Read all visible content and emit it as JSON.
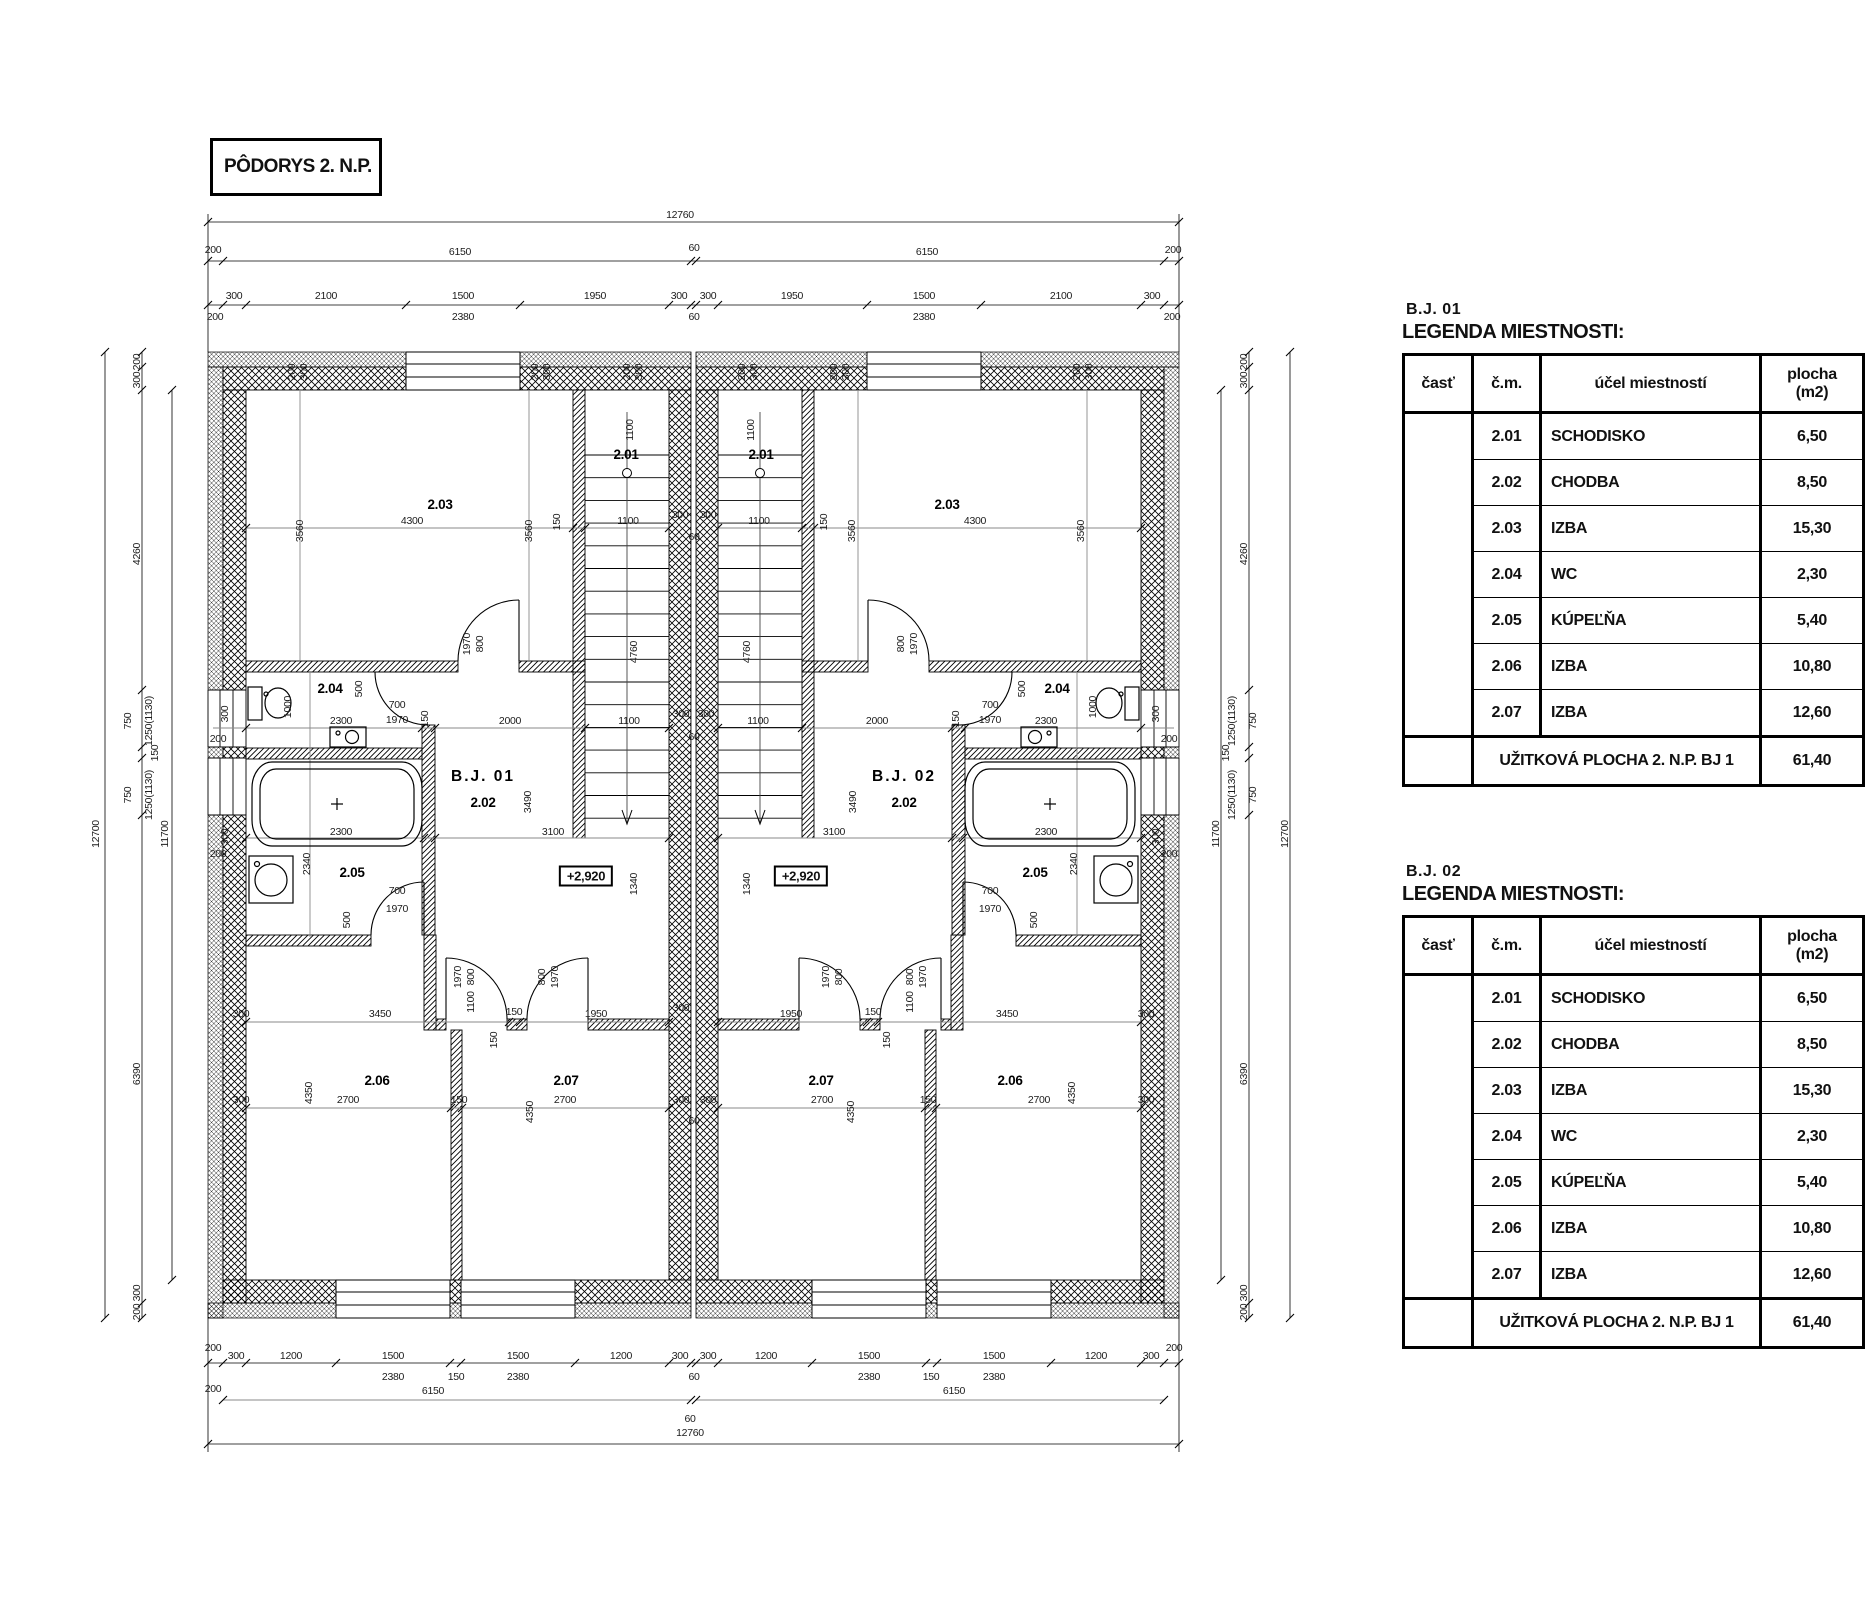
{
  "title_block": {
    "title": "PÔDORYS 2. N.P."
  },
  "legend_tables": [
    {
      "unit": "B.J.  01",
      "heading": "LEGENDA MIESTNOSTI:",
      "columns": {
        "part": "časť",
        "num": "č.m.",
        "purpose": "účel miestností",
        "area1": "plocha",
        "area2": "(m2)"
      },
      "rows": [
        {
          "num": "2.01",
          "name": "SCHODISKO",
          "area": "6,50"
        },
        {
          "num": "2.02",
          "name": "CHODBA",
          "area": "8,50"
        },
        {
          "num": "2.03",
          "name": "IZBA",
          "area": "15,30"
        },
        {
          "num": "2.04",
          "name": "WC",
          "area": "2,30"
        },
        {
          "num": "2.05",
          "name": "KÚPEĽŇA",
          "area": "5,40"
        },
        {
          "num": "2.06",
          "name": "IZBA",
          "area": "10,80"
        },
        {
          "num": "2.07",
          "name": "IZBA",
          "area": "12,60"
        }
      ],
      "footer_label": "UŽITKOVÁ PLOCHA 2. N.P. BJ 1",
      "footer_value": "61,40"
    },
    {
      "unit": "B.J.  02",
      "heading": "LEGENDA MIESTNOSTI:",
      "columns": {
        "part": "časť",
        "num": "č.m.",
        "purpose": "účel miestností",
        "area1": "plocha",
        "area2": "(m2)"
      },
      "rows": [
        {
          "num": "2.01",
          "name": "SCHODISKO",
          "area": "6,50"
        },
        {
          "num": "2.02",
          "name": "CHODBA",
          "area": "8,50"
        },
        {
          "num": "2.03",
          "name": "IZBA",
          "area": "15,30"
        },
        {
          "num": "2.04",
          "name": "WC",
          "area": "2,30"
        },
        {
          "num": "2.05",
          "name": "KÚPEĽŇA",
          "area": "5,40"
        },
        {
          "num": "2.06",
          "name": "IZBA",
          "area": "10,80"
        },
        {
          "num": "2.07",
          "name": "IZBA",
          "area": "12,60"
        }
      ],
      "footer_label": "UŽITKOVÁ PLOCHA 2. N.P. BJ 1",
      "footer_value": "61,40"
    }
  ],
  "plan": {
    "room_labels": [
      {
        "t": "2.03",
        "x": 440,
        "y": 509
      },
      {
        "t": "2.01",
        "x": 626,
        "y": 459
      },
      {
        "t": "2.04",
        "x": 330,
        "y": 693
      },
      {
        "t": "2.05",
        "x": 352,
        "y": 877
      },
      {
        "t": "2.06",
        "x": 377,
        "y": 1085
      },
      {
        "t": "2.07",
        "x": 566,
        "y": 1085
      },
      {
        "t": "2.02",
        "x": 483,
        "y": 807
      },
      {
        "t": "2.03",
        "x": 947,
        "y": 509
      },
      {
        "t": "2.01",
        "x": 761,
        "y": 459
      },
      {
        "t": "2.04",
        "x": 1057,
        "y": 693
      },
      {
        "t": "2.05",
        "x": 1035,
        "y": 877
      },
      {
        "t": "2.06",
        "x": 1010,
        "y": 1085
      },
      {
        "t": "2.07",
        "x": 821,
        "y": 1085
      },
      {
        "t": "2.02",
        "x": 904,
        "y": 807
      }
    ],
    "unit_labels": [
      {
        "t": "B.J. 01",
        "x": 483,
        "y": 781
      },
      {
        "t": "B.J. 02",
        "x": 904,
        "y": 781
      }
    ],
    "level_markers": [
      {
        "t": "+2,920",
        "x": 586,
        "y": 876
      },
      {
        "t": "+2,920",
        "x": 801,
        "y": 876
      }
    ],
    "dims": [
      {
        "t": "12760",
        "x": 680,
        "y": 218
      },
      {
        "t": "6150",
        "x": 460,
        "y": 255
      },
      {
        "t": "60",
        "x": 694,
        "y": 251
      },
      {
        "t": "6150",
        "x": 927,
        "y": 255
      },
      {
        "t": "200",
        "x": 213,
        "y": 253
      },
      {
        "t": "200",
        "x": 1173,
        "y": 253
      },
      {
        "t": "300",
        "x": 234,
        "y": 299
      },
      {
        "t": "2100",
        "x": 326,
        "y": 299
      },
      {
        "t": "1500",
        "x": 463,
        "y": 299
      },
      {
        "t": "1950",
        "x": 595,
        "y": 299
      },
      {
        "t": "300",
        "x": 679,
        "y": 299
      },
      {
        "t": "300",
        "x": 708,
        "y": 299
      },
      {
        "t": "1950",
        "x": 792,
        "y": 299
      },
      {
        "t": "1500",
        "x": 924,
        "y": 299
      },
      {
        "t": "2100",
        "x": 1061,
        "y": 299
      },
      {
        "t": "300",
        "x": 1152,
        "y": 299
      },
      {
        "t": "2380",
        "x": 463,
        "y": 320
      },
      {
        "t": "60",
        "x": 694,
        "y": 320
      },
      {
        "t": "2380",
        "x": 924,
        "y": 320
      },
      {
        "t": "200",
        "x": 215,
        "y": 320
      },
      {
        "t": "200",
        "x": 1172,
        "y": 320
      },
      {
        "t": "200",
        "x": 295,
        "y": 372,
        "r": 1
      },
      {
        "t": "300",
        "x": 307,
        "y": 372,
        "r": 1
      },
      {
        "t": "200",
        "x": 538,
        "y": 372,
        "r": 1
      },
      {
        "t": "300",
        "x": 550,
        "y": 372,
        "r": 1
      },
      {
        "t": "200",
        "x": 630,
        "y": 372,
        "r": 1
      },
      {
        "t": "300",
        "x": 642,
        "y": 372,
        "r": 1
      },
      {
        "t": "200",
        "x": 745,
        "y": 372,
        "r": 1
      },
      {
        "t": "300",
        "x": 757,
        "y": 372,
        "r": 1
      },
      {
        "t": "200",
        "x": 837,
        "y": 372,
        "r": 1
      },
      {
        "t": "300",
        "x": 849,
        "y": 372,
        "r": 1
      },
      {
        "t": "200",
        "x": 1080,
        "y": 372,
        "r": 1
      },
      {
        "t": "300",
        "x": 1092,
        "y": 372,
        "r": 1
      },
      {
        "t": "12700",
        "x": 99,
        "y": 834,
        "r": 1
      },
      {
        "t": "11700",
        "x": 168,
        "y": 834,
        "r": 1
      },
      {
        "t": "200",
        "x": 140,
        "y": 362,
        "r": 1
      },
      {
        "t": "300",
        "x": 140,
        "y": 380,
        "r": 1
      },
      {
        "t": "4260",
        "x": 140,
        "y": 554,
        "r": 1
      },
      {
        "t": "750",
        "x": 131,
        "y": 721,
        "r": 1
      },
      {
        "t": "1250(1130)",
        "x": 152,
        "y": 721,
        "r": 1
      },
      {
        "t": "150",
        "x": 158,
        "y": 753,
        "r": 1
      },
      {
        "t": "750",
        "x": 131,
        "y": 795,
        "r": 1
      },
      {
        "t": "1250(1130)",
        "x": 152,
        "y": 795,
        "r": 1
      },
      {
        "t": "6390",
        "x": 140,
        "y": 1074,
        "r": 1
      },
      {
        "t": "300",
        "x": 140,
        "y": 1293,
        "r": 1
      },
      {
        "t": "200",
        "x": 140,
        "y": 1312,
        "r": 1
      },
      {
        "t": "300",
        "x": 228,
        "y": 714,
        "r": 1
      },
      {
        "t": "200",
        "x": 218,
        "y": 742
      },
      {
        "t": "300",
        "x": 228,
        "y": 837,
        "r": 1
      },
      {
        "t": "200",
        "x": 218,
        "y": 857
      },
      {
        "t": "12700",
        "x": 1288,
        "y": 834,
        "r": 1
      },
      {
        "t": "11700",
        "x": 1219,
        "y": 834,
        "r": 1
      },
      {
        "t": "200",
        "x": 1247,
        "y": 362,
        "r": 1
      },
      {
        "t": "300",
        "x": 1247,
        "y": 380,
        "r": 1
      },
      {
        "t": "4260",
        "x": 1247,
        "y": 554,
        "r": 1
      },
      {
        "t": "750",
        "x": 1256,
        "y": 721,
        "r": 1
      },
      {
        "t": "1250(1130)",
        "x": 1235,
        "y": 721,
        "r": 1
      },
      {
        "t": "150",
        "x": 1229,
        "y": 753,
        "r": 1
      },
      {
        "t": "750",
        "x": 1256,
        "y": 795,
        "r": 1
      },
      {
        "t": "1250(1130)",
        "x": 1235,
        "y": 795,
        "r": 1
      },
      {
        "t": "6390",
        "x": 1247,
        "y": 1074,
        "r": 1
      },
      {
        "t": "300",
        "x": 1247,
        "y": 1293,
        "r": 1
      },
      {
        "t": "200",
        "x": 1247,
        "y": 1312,
        "r": 1
      },
      {
        "t": "300",
        "x": 1159,
        "y": 714,
        "r": 1
      },
      {
        "t": "200",
        "x": 1169,
        "y": 742
      },
      {
        "t": "300",
        "x": 1159,
        "y": 837,
        "r": 1
      },
      {
        "t": "200",
        "x": 1169,
        "y": 857
      },
      {
        "t": "200",
        "x": 213,
        "y": 1351
      },
      {
        "t": "300",
        "x": 236,
        "y": 1359
      },
      {
        "t": "1200",
        "x": 291,
        "y": 1359
      },
      {
        "t": "1500",
        "x": 393,
        "y": 1359
      },
      {
        "t": "1500",
        "x": 518,
        "y": 1359
      },
      {
        "t": "1200",
        "x": 621,
        "y": 1359
      },
      {
        "t": "300",
        "x": 680,
        "y": 1359
      },
      {
        "t": "300",
        "x": 708,
        "y": 1359
      },
      {
        "t": "1200",
        "x": 766,
        "y": 1359
      },
      {
        "t": "1500",
        "x": 869,
        "y": 1359
      },
      {
        "t": "1500",
        "x": 994,
        "y": 1359
      },
      {
        "t": "1200",
        "x": 1096,
        "y": 1359
      },
      {
        "t": "300",
        "x": 1151,
        "y": 1359
      },
      {
        "t": "200",
        "x": 1174,
        "y": 1351
      },
      {
        "t": "2380",
        "x": 393,
        "y": 1380
      },
      {
        "t": "150",
        "x": 456,
        "y": 1380
      },
      {
        "t": "2380",
        "x": 518,
        "y": 1380
      },
      {
        "t": "2380",
        "x": 869,
        "y": 1380
      },
      {
        "t": "150",
        "x": 931,
        "y": 1380
      },
      {
        "t": "2380",
        "x": 994,
        "y": 1380
      },
      {
        "t": "60",
        "x": 694,
        "y": 1380
      },
      {
        "t": "200",
        "x": 213,
        "y": 1392
      },
      {
        "t": "6150",
        "x": 433,
        "y": 1394
      },
      {
        "t": "6150",
        "x": 954,
        "y": 1394
      },
      {
        "t": "60",
        "x": 690,
        "y": 1422
      },
      {
        "t": "12760",
        "x": 690,
        "y": 1436
      },
      {
        "t": "3560",
        "x": 303,
        "y": 531,
        "r": 1
      },
      {
        "t": "4300",
        "x": 412,
        "y": 524
      },
      {
        "t": "3560",
        "x": 532,
        "y": 531,
        "r": 1
      },
      {
        "t": "150",
        "x": 560,
        "y": 522,
        "r": 1
      },
      {
        "t": "1100",
        "x": 628,
        "y": 524
      },
      {
        "t": "300",
        "x": 680,
        "y": 518
      },
      {
        "t": "300",
        "x": 708,
        "y": 518
      },
      {
        "t": "60",
        "x": 694,
        "y": 540
      },
      {
        "t": "1100",
        "x": 759,
        "y": 524
      },
      {
        "t": "150",
        "x": 827,
        "y": 522,
        "r": 1
      },
      {
        "t": "3560",
        "x": 855,
        "y": 531,
        "r": 1
      },
      {
        "t": "4300",
        "x": 975,
        "y": 524
      },
      {
        "t": "3560",
        "x": 1084,
        "y": 531,
        "r": 1
      },
      {
        "t": "1100",
        "x": 633,
        "y": 430,
        "r": 1
      },
      {
        "t": "1100",
        "x": 754,
        "y": 430,
        "r": 1
      },
      {
        "t": "4760",
        "x": 637,
        "y": 652,
        "r": 1
      },
      {
        "t": "4760",
        "x": 750,
        "y": 652,
        "r": 1
      },
      {
        "t": "1970",
        "x": 470,
        "y": 644,
        "r": 1
      },
      {
        "t": "800",
        "x": 483,
        "y": 644,
        "r": 1
      },
      {
        "t": "1970",
        "x": 917,
        "y": 644,
        "r": 1
      },
      {
        "t": "800",
        "x": 904,
        "y": 644,
        "r": 1
      },
      {
        "t": "2300",
        "x": 341,
        "y": 724
      },
      {
        "t": "150",
        "x": 428,
        "y": 719,
        "r": 1
      },
      {
        "t": "2000",
        "x": 510,
        "y": 724
      },
      {
        "t": "1100",
        "x": 629,
        "y": 724
      },
      {
        "t": "300",
        "x": 681,
        "y": 717
      },
      {
        "t": "60",
        "x": 694,
        "y": 740
      },
      {
        "t": "300",
        "x": 706,
        "y": 717
      },
      {
        "t": "1100",
        "x": 758,
        "y": 724
      },
      {
        "t": "2000",
        "x": 877,
        "y": 724
      },
      {
        "t": "150",
        "x": 959,
        "y": 719,
        "r": 1
      },
      {
        "t": "2300",
        "x": 1046,
        "y": 724
      },
      {
        "t": "700",
        "x": 397,
        "y": 708
      },
      {
        "t": "1970",
        "x": 397,
        "y": 723
      },
      {
        "t": "700",
        "x": 990,
        "y": 708
      },
      {
        "t": "1970",
        "x": 990,
        "y": 723
      },
      {
        "t": "1000",
        "x": 291,
        "y": 707,
        "r": 1
      },
      {
        "t": "1000",
        "x": 1096,
        "y": 707,
        "r": 1
      },
      {
        "t": "500",
        "x": 362,
        "y": 689,
        "r": 1
      },
      {
        "t": "500",
        "x": 1025,
        "y": 689,
        "r": 1
      },
      {
        "t": "2300",
        "x": 341,
        "y": 835
      },
      {
        "t": "3100",
        "x": 553,
        "y": 835
      },
      {
        "t": "3100",
        "x": 834,
        "y": 835
      },
      {
        "t": "2300",
        "x": 1046,
        "y": 835
      },
      {
        "t": "3490",
        "x": 531,
        "y": 802,
        "r": 1
      },
      {
        "t": "3490",
        "x": 856,
        "y": 802,
        "r": 1
      },
      {
        "t": "1340",
        "x": 637,
        "y": 884,
        "r": 1
      },
      {
        "t": "1340",
        "x": 750,
        "y": 884,
        "r": 1
      },
      {
        "t": "2340",
        "x": 310,
        "y": 864,
        "r": 1
      },
      {
        "t": "2340",
        "x": 1077,
        "y": 864,
        "r": 1
      },
      {
        "t": "700",
        "x": 397,
        "y": 894
      },
      {
        "t": "1970",
        "x": 397,
        "y": 912
      },
      {
        "t": "500",
        "x": 350,
        "y": 920,
        "r": 1
      },
      {
        "t": "700",
        "x": 990,
        "y": 894
      },
      {
        "t": "1970",
        "x": 990,
        "y": 912
      },
      {
        "t": "500",
        "x": 1037,
        "y": 920,
        "r": 1
      },
      {
        "t": "300",
        "x": 241,
        "y": 1017
      },
      {
        "t": "3450",
        "x": 380,
        "y": 1017
      },
      {
        "t": "150",
        "x": 514,
        "y": 1015
      },
      {
        "t": "1950",
        "x": 596,
        "y": 1017
      },
      {
        "t": "300",
        "x": 681,
        "y": 1011
      },
      {
        "t": "1950",
        "x": 791,
        "y": 1017
      },
      {
        "t": "150",
        "x": 873,
        "y": 1015
      },
      {
        "t": "3450",
        "x": 1007,
        "y": 1017
      },
      {
        "t": "300",
        "x": 1146,
        "y": 1017
      },
      {
        "t": "1970",
        "x": 461,
        "y": 977,
        "r": 1
      },
      {
        "t": "800",
        "x": 474,
        "y": 977,
        "r": 1
      },
      {
        "t": "1100",
        "x": 474,
        "y": 1002,
        "r": 1
      },
      {
        "t": "1970",
        "x": 558,
        "y": 977,
        "r": 1
      },
      {
        "t": "800",
        "x": 545,
        "y": 977,
        "r": 1
      },
      {
        "t": "1970",
        "x": 926,
        "y": 977,
        "r": 1
      },
      {
        "t": "800",
        "x": 913,
        "y": 977,
        "r": 1
      },
      {
        "t": "1100",
        "x": 913,
        "y": 1002,
        "r": 1
      },
      {
        "t": "1970",
        "x": 829,
        "y": 977,
        "r": 1
      },
      {
        "t": "800",
        "x": 842,
        "y": 977,
        "r": 1
      },
      {
        "t": "150",
        "x": 497,
        "y": 1040,
        "r": 1
      },
      {
        "t": "150",
        "x": 890,
        "y": 1040,
        "r": 1
      },
      {
        "t": "300",
        "x": 241,
        "y": 1103
      },
      {
        "t": "2700",
        "x": 348,
        "y": 1103
      },
      {
        "t": "150",
        "x": 459,
        "y": 1103
      },
      {
        "t": "2700",
        "x": 565,
        "y": 1103
      },
      {
        "t": "300",
        "x": 681,
        "y": 1103
      },
      {
        "t": "300",
        "x": 708,
        "y": 1103
      },
      {
        "t": "60",
        "x": 694,
        "y": 1124
      },
      {
        "t": "2700",
        "x": 822,
        "y": 1103
      },
      {
        "t": "150",
        "x": 928,
        "y": 1103
      },
      {
        "t": "2700",
        "x": 1039,
        "y": 1103
      },
      {
        "t": "300",
        "x": 1146,
        "y": 1103
      },
      {
        "t": "4350",
        "x": 312,
        "y": 1093,
        "r": 1
      },
      {
        "t": "4350",
        "x": 533,
        "y": 1112,
        "r": 1
      },
      {
        "t": "4350",
        "x": 854,
        "y": 1112,
        "r": 1
      },
      {
        "t": "4350",
        "x": 1075,
        "y": 1093,
        "r": 1
      }
    ]
  }
}
